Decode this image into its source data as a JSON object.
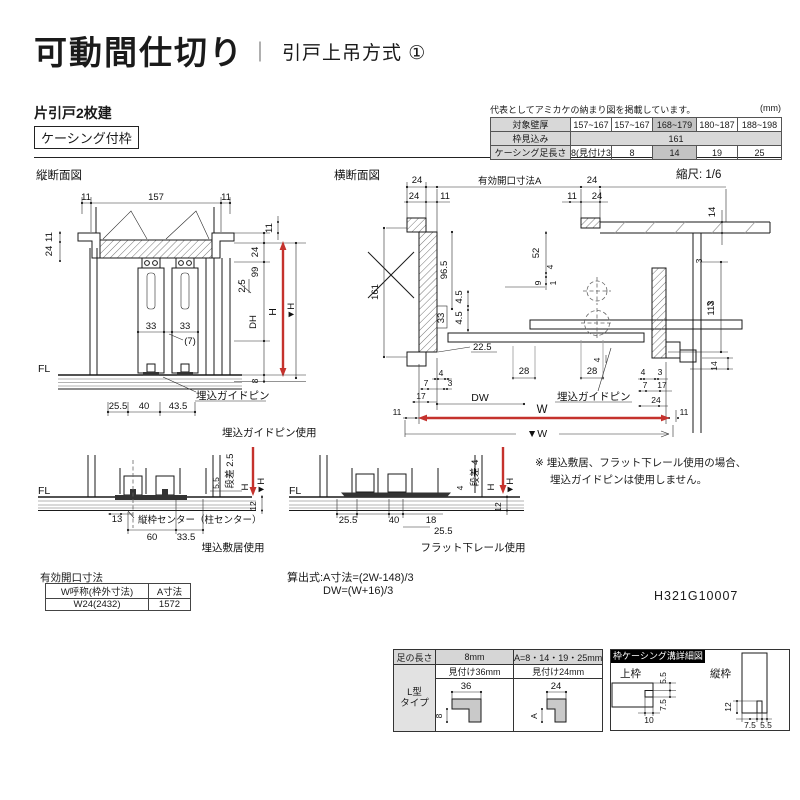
{
  "colors": {
    "accent_red": "#c5322d",
    "table_header_gray": "#d8d8d8",
    "highlight_gray": "#c3c3c3"
  },
  "header": {
    "title": "可動間仕切り",
    "separator": "｜",
    "method": "引戸上吊方式 ①"
  },
  "product": {
    "type": "片引戸2枚建",
    "frame": "ケーシング付枠"
  },
  "spec_table": {
    "note": "代表としてアミカケの納まり図を掲載しています。",
    "unit": "(mm)",
    "row_headers": [
      "対象壁厚",
      "枠見込み",
      "ケーシング足長さ"
    ],
    "wall_thickness": [
      "157~167",
      "157~167",
      "168~179",
      "180~187",
      "188~198"
    ],
    "frame_depth": "161",
    "casing_leg": [
      "8(見付け36)",
      "8",
      "14",
      "19",
      "25"
    ]
  },
  "vertical_section": {
    "title": "縦断面図",
    "d11": "11",
    "d157": "157",
    "d24": "24",
    "d99": "99",
    "d2_5": "2.5",
    "dDH": "DH",
    "dH": "H",
    "dVH": "▼H",
    "d8": "8",
    "d33": "33",
    "d7p": "(7)",
    "dFL": "FL",
    "d25_5": "25.5",
    "d40": "40",
    "d43_5": "43.5",
    "pin_label": "埋込ガイドピン",
    "caption": "埋込ガイドピン使用"
  },
  "horizontal_section": {
    "title": "横断面図",
    "scale": "縮尺: 1/6",
    "opening_label": "有効開口寸法A",
    "d24": "24",
    "d11": "11",
    "d161": "161",
    "d96_5": "96.5",
    "d4_5": "4.5",
    "d33": "33",
    "d22_5": "22.5",
    "d52": "52",
    "d4": "4",
    "d9": "9",
    "d1": "1",
    "d14": "14",
    "d3": "3",
    "d113": "113",
    "d7": "7",
    "d17": "17",
    "d28": "28",
    "dDW": "DW",
    "dW": "W",
    "dVW": "▼W",
    "pin_label": "埋込ガイドピン"
  },
  "detail_sill": {
    "dFL": "FL",
    "step": "段差 2.5",
    "d5_5": "5.5",
    "dH": "H",
    "dVH": "▼H",
    "d12": "12",
    "d13": "13",
    "center_label": "縦枠センター（柱センター）",
    "d60": "60",
    "d33_5": "33.5",
    "caption": "埋込敷居使用"
  },
  "detail_rail": {
    "dFL": "FL",
    "step": "段差 4",
    "d4": "4",
    "dH": "H",
    "dVH": "▼H",
    "d12": "12",
    "d25_5": "25.5",
    "d40": "40",
    "d18": "18",
    "caption": "フラット下レール使用"
  },
  "note": {
    "line1": "※ 埋込敷居、フラット下レール使用の場合、",
    "line2": "埋込ガイドピンは使用しません。"
  },
  "opening_table": {
    "title": "有効開口寸法",
    "col1": "W呼称(枠外寸法)",
    "col2": "A寸法",
    "val1": "W24(2432)",
    "val2": "1572"
  },
  "formula": {
    "line1": "算出式:A寸法=(2W-148)/3",
    "line2": "DW=(W+16)/3"
  },
  "doc_number": "H321G10007",
  "casing_table": {
    "leg_header": "足の長さ",
    "leg8": "8mm",
    "legA": "A=8・14・19・25mm",
    "type1": "L型",
    "type2": "タイプ",
    "face36": "見付け36mm",
    "face24": "見付け24mm",
    "d36": "36",
    "d8": "8",
    "d24": "24",
    "dA": "A"
  },
  "groove_panel": {
    "title": "枠ケーシング溝詳細図",
    "top_frame": "上枠",
    "side_frame": "縦枠",
    "d5_5": "5.5",
    "d7_5": "7.5",
    "d10": "10",
    "d12": "12"
  }
}
